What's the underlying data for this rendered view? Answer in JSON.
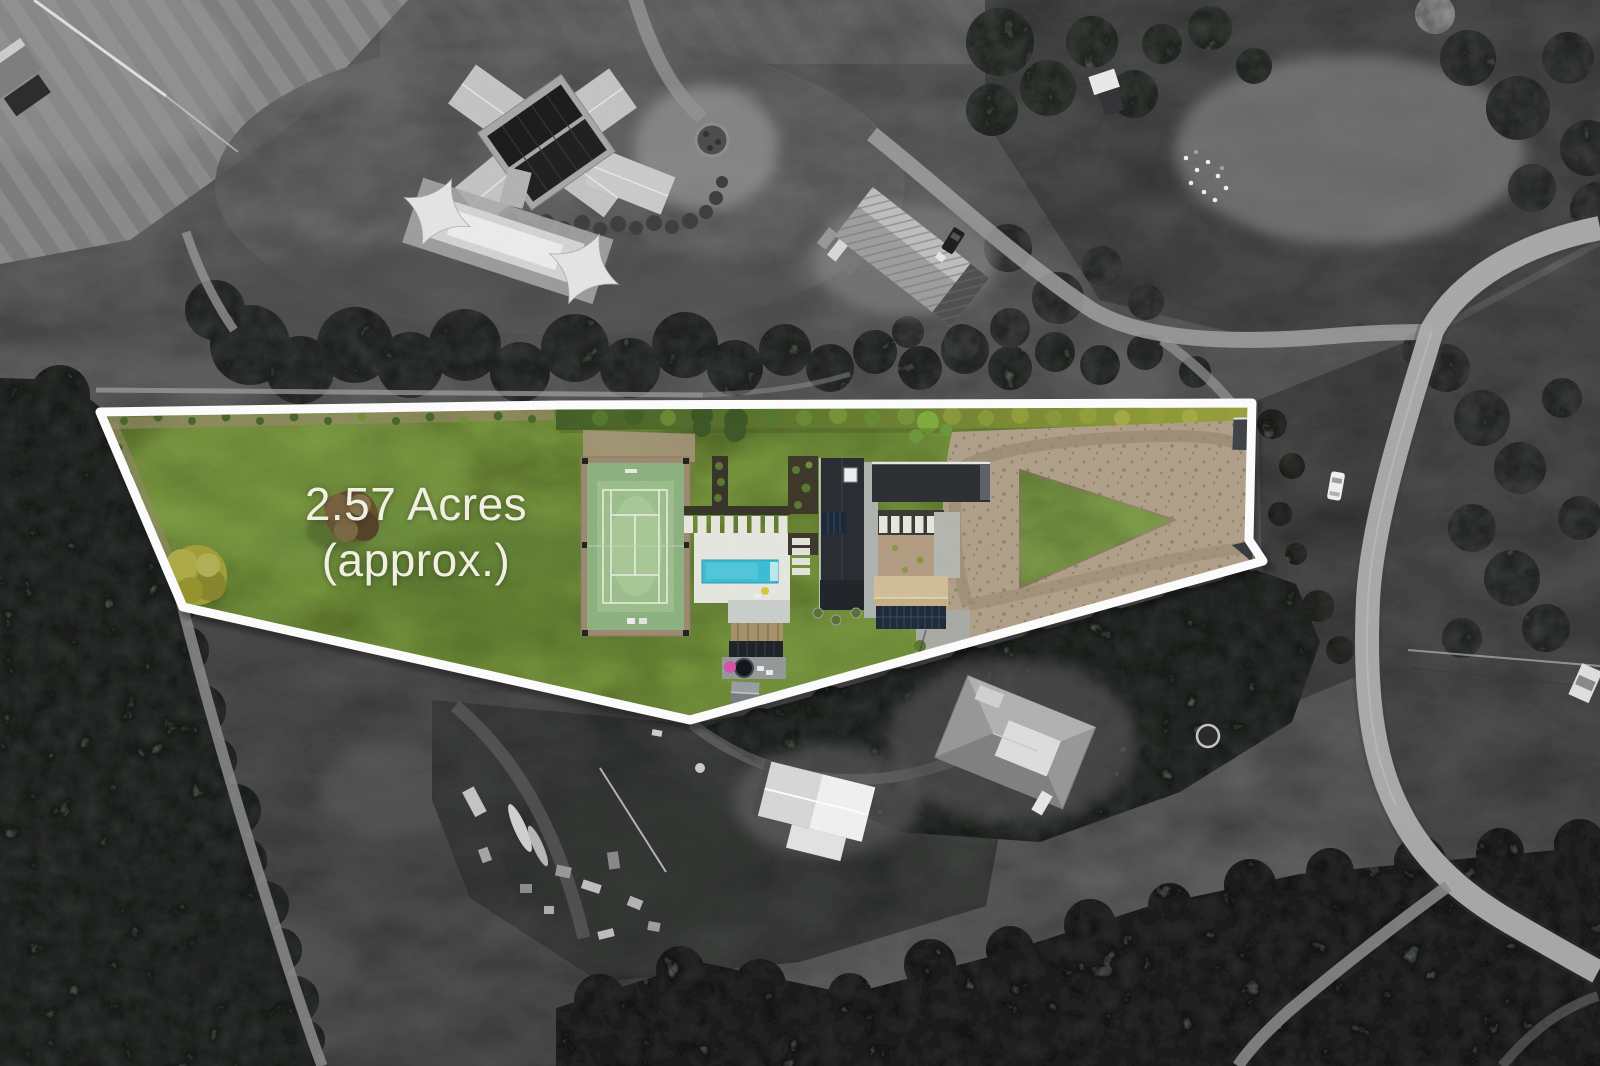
{
  "annotation": {
    "line1": "2.57 Acres",
    "line2": "(approx.)"
  },
  "alt": "Aerial photograph: 2.57 acre (approx.) property highlighted in colour with a white boundary outline, surroundings shown in black and white",
  "colors": {
    "boundary": "#ffffff",
    "text": "#f5f3e6",
    "lawn": "#76943e",
    "hedge_dark": "#46622a",
    "hedge_light": "#9aa43e",
    "pool": "#3fc0d6",
    "court": "#8fb483",
    "court_border": "#a08c74",
    "gravel": "#b3a28b",
    "garage_roof": "#c8b28a",
    "house_roof": "#2b2f33",
    "deck": "#969c9c",
    "umbrella_pink": "#d757a8"
  }
}
